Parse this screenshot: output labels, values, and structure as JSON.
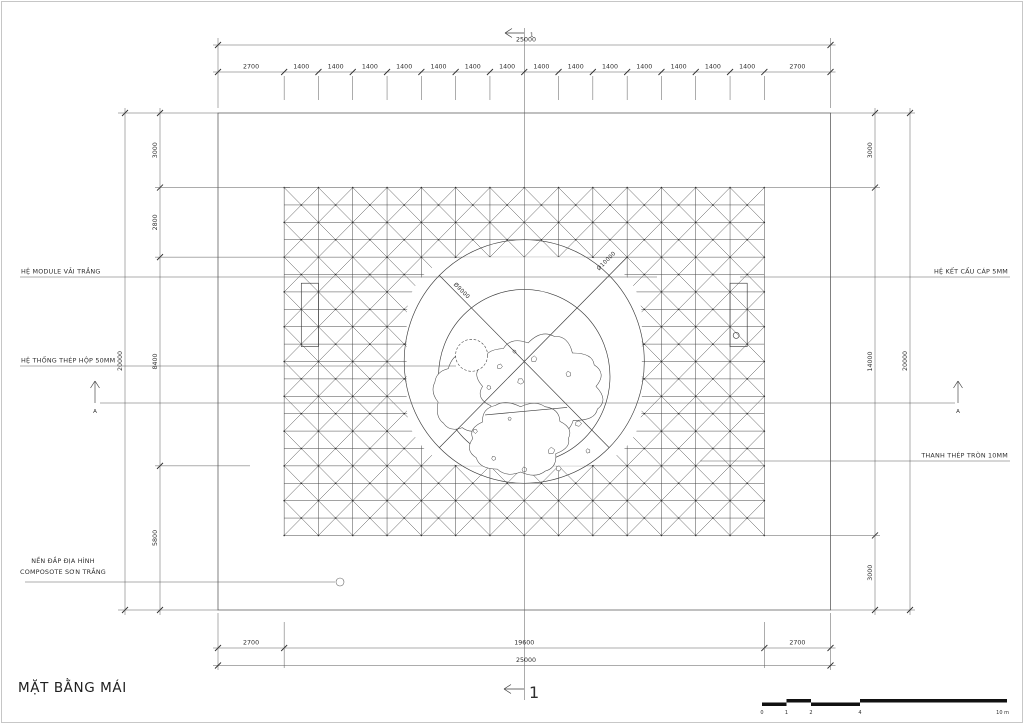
{
  "title": "MẶT BẰNG MÁI",
  "dimensions": {
    "top": {
      "overall": "25000",
      "segments": [
        "2700",
        "1400",
        "1400",
        "1400",
        "1400",
        "1400",
        "1400",
        "1400",
        "1400",
        "1400",
        "1400",
        "1400",
        "1400",
        "1400",
        "1400",
        "2700"
      ]
    },
    "bottom": {
      "segments": [
        "2700",
        "19600",
        "2700"
      ],
      "overall": "25000"
    },
    "left": {
      "overall": "20000",
      "segments": [
        "3000",
        "2800",
        "8400",
        "5800"
      ]
    },
    "right": {
      "overall": "20000",
      "segments": [
        "3000",
        "14000",
        "3000"
      ]
    }
  },
  "annotations": {
    "left": [
      "HỆ MODULE VẢI TRẮNG",
      "HỆ THỐNG THÉP HỘP 50MM"
    ],
    "left_multiline": [
      "NỀN ĐẮP ĐỊA HÌNH",
      "COMPOSOTE SƠN TRẮNG"
    ],
    "right": [
      "HỆ KẾT CẤU CÁP 5MM",
      "THANH THÉP TRÒN 10MM"
    ]
  },
  "circle_labels": [
    "Ø9000",
    "Ø10000"
  ],
  "section_markers": {
    "vertical": "1",
    "horizontal": "A"
  },
  "scale_bar": {
    "labels": [
      "0",
      "1",
      "2",
      "4"
    ],
    "end_label": "10 m"
  }
}
